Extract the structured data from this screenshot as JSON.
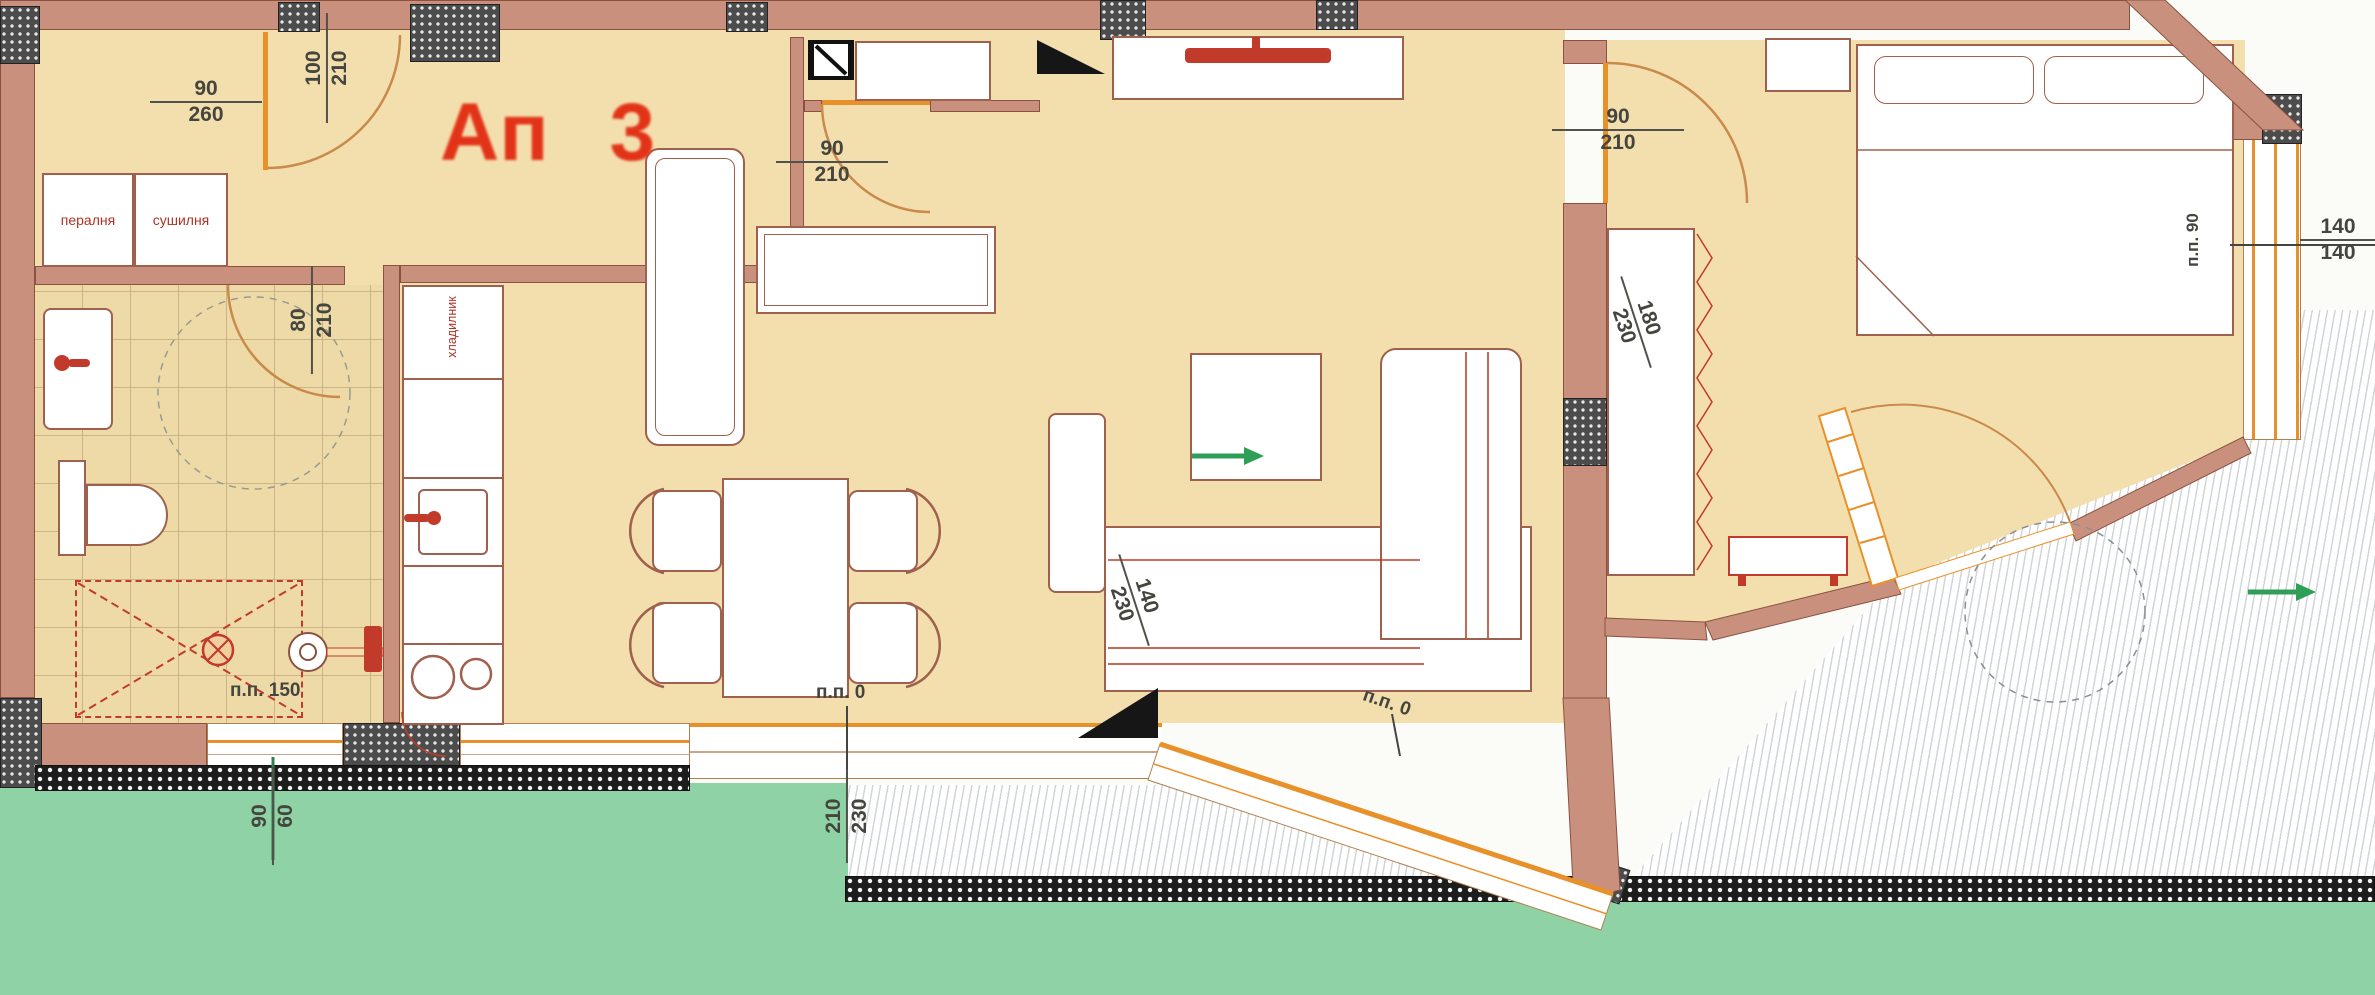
{
  "plan": {
    "title": "Ап 3",
    "colors": {
      "wall": "#c9917d",
      "floor": "#f3dfad",
      "tile": "#eedaa6",
      "green": "#8ed2a5",
      "orange_frame": "#e8912a",
      "fixture_red": "#c23b2a",
      "title_red": "#e23318"
    },
    "rooms": {
      "washer": "пералня",
      "dryer": "сушилня",
      "fridge": "хладилник"
    },
    "dims": {
      "laundry_window": {
        "top": "90",
        "bottom": "260"
      },
      "hall_door": {
        "top": "100",
        "bottom": "210"
      },
      "entry_door": {
        "top": "90",
        "bottom": "210"
      },
      "bath_door": {
        "top": "80",
        "bottom": "210"
      },
      "bedroom_door": {
        "top": "90",
        "bottom": "210"
      },
      "right_window": {
        "top": "140",
        "bottom": "140"
      },
      "bath_window": {
        "top": "90",
        "bottom": "60"
      },
      "living_terrace_door": {
        "top": "210",
        "bottom": "230"
      },
      "terrace_door_small": {
        "top": "140",
        "bottom": "230"
      },
      "bedroom_terrace_door": {
        "top": "180",
        "bottom": "230"
      }
    },
    "annotations": {
      "shower_parapet": "п.п. 150",
      "dining_parapet": "п.п. 0",
      "terrace_parapet": "п.п. 0",
      "bedroom_window_parapet": "п.п. 90"
    }
  }
}
